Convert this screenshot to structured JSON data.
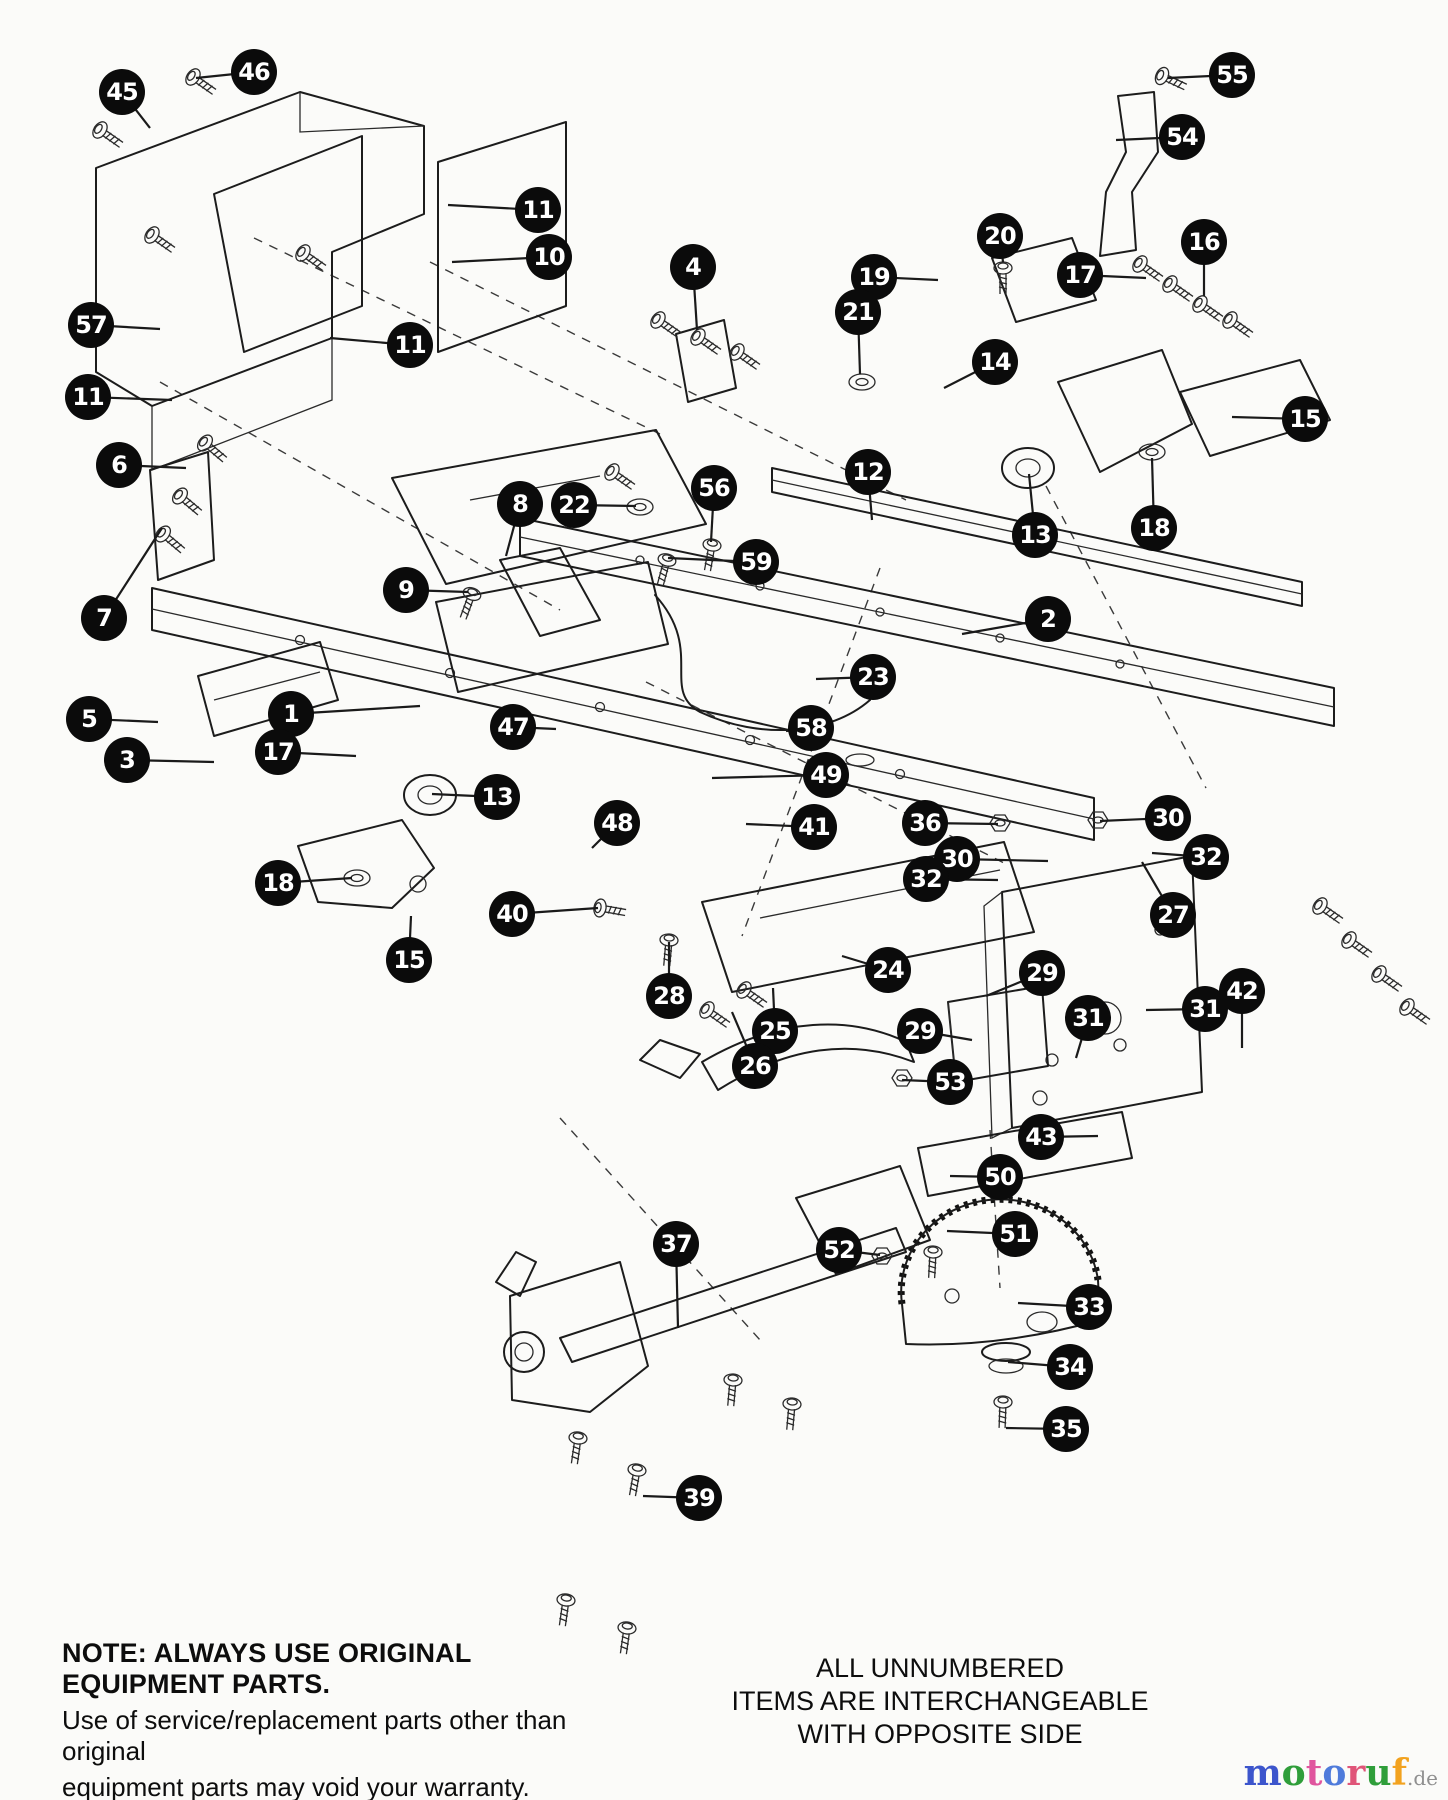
{
  "page": {
    "width": 1448,
    "height": 1800,
    "background": "#fbfbf9"
  },
  "diagram": {
    "description": "Exploded parts diagram of tractor frame assembly",
    "callout_style": {
      "fill": "#0b0b0b",
      "text_color": "#ffffff",
      "diameter": 46,
      "leader_color": "#1a1a1a"
    },
    "callouts": [
      {
        "n": "45",
        "x": 122,
        "y": 92,
        "tx": 150,
        "ty": 128
      },
      {
        "n": "46",
        "x": 254,
        "y": 72,
        "tx": 196,
        "ty": 78
      },
      {
        "n": "55",
        "x": 1232,
        "y": 75,
        "tx": 1168,
        "ty": 78
      },
      {
        "n": "54",
        "x": 1182,
        "y": 137,
        "tx": 1116,
        "ty": 140
      },
      {
        "n": "11",
        "x": 538,
        "y": 210,
        "tx": 448,
        "ty": 205
      },
      {
        "n": "10",
        "x": 549,
        "y": 257,
        "tx": 452,
        "ty": 262
      },
      {
        "n": "20",
        "x": 1000,
        "y": 236,
        "tx": 1003,
        "ty": 262
      },
      {
        "n": "16",
        "x": 1204,
        "y": 242,
        "tx": 1204,
        "ty": 296
      },
      {
        "n": "19",
        "x": 874,
        "y": 277,
        "tx": 938,
        "ty": 280
      },
      {
        "n": "17",
        "x": 1080,
        "y": 275,
        "tx": 1146,
        "ty": 278
      },
      {
        "n": "21",
        "x": 858,
        "y": 312,
        "tx": 860,
        "ty": 374
      },
      {
        "n": "4",
        "x": 693,
        "y": 267,
        "tx": 697,
        "ty": 330
      },
      {
        "n": "57",
        "x": 91,
        "y": 325,
        "tx": 160,
        "ty": 329
      },
      {
        "n": "11",
        "x": 410,
        "y": 345,
        "tx": 330,
        "ty": 338
      },
      {
        "n": "14",
        "x": 995,
        "y": 362,
        "tx": 944,
        "ty": 388
      },
      {
        "n": "11",
        "x": 88,
        "y": 397,
        "tx": 172,
        "ty": 400
      },
      {
        "n": "15",
        "x": 1305,
        "y": 419,
        "tx": 1232,
        "ty": 417
      },
      {
        "n": "6",
        "x": 119,
        "y": 465,
        "tx": 186,
        "ty": 468
      },
      {
        "n": "12",
        "x": 868,
        "y": 472,
        "tx": 872,
        "ty": 520
      },
      {
        "n": "8",
        "x": 520,
        "y": 504,
        "tx": 506,
        "ty": 556
      },
      {
        "n": "22",
        "x": 574,
        "y": 505,
        "tx": 636,
        "ty": 506
      },
      {
        "n": "56",
        "x": 714,
        "y": 488,
        "tx": 711,
        "ty": 542
      },
      {
        "n": "13",
        "x": 1035,
        "y": 535,
        "tx": 1029,
        "ty": 474
      },
      {
        "n": "18",
        "x": 1154,
        "y": 528,
        "tx": 1152,
        "ty": 458
      },
      {
        "n": "59",
        "x": 756,
        "y": 562,
        "tx": 668,
        "ty": 558
      },
      {
        "n": "9",
        "x": 406,
        "y": 590,
        "tx": 468,
        "ty": 592
      },
      {
        "n": "2",
        "x": 1048,
        "y": 619,
        "tx": 962,
        "ty": 634
      },
      {
        "n": "7",
        "x": 104,
        "y": 618,
        "tx": 162,
        "ty": 528
      },
      {
        "n": "23",
        "x": 873,
        "y": 677,
        "tx": 816,
        "ty": 679
      },
      {
        "n": "5",
        "x": 89,
        "y": 719,
        "tx": 158,
        "ty": 722
      },
      {
        "n": "1",
        "x": 291,
        "y": 714,
        "tx": 420,
        "ty": 706
      },
      {
        "n": "47",
        "x": 513,
        "y": 727,
        "tx": 556,
        "ty": 729
      },
      {
        "n": "58",
        "x": 811,
        "y": 728,
        "tx": 786,
        "ty": 731
      },
      {
        "n": "3",
        "x": 127,
        "y": 760,
        "tx": 214,
        "ty": 762
      },
      {
        "n": "17",
        "x": 278,
        "y": 752,
        "tx": 356,
        "ty": 756
      },
      {
        "n": "49",
        "x": 826,
        "y": 775,
        "tx": 712,
        "ty": 778
      },
      {
        "n": "13",
        "x": 497,
        "y": 797,
        "tx": 432,
        "ty": 794
      },
      {
        "n": "48",
        "x": 617,
        "y": 823,
        "tx": 592,
        "ty": 848
      },
      {
        "n": "30",
        "x": 1168,
        "y": 818,
        "tx": 1100,
        "ty": 821
      },
      {
        "n": "41",
        "x": 814,
        "y": 827,
        "tx": 746,
        "ty": 824
      },
      {
        "n": "36",
        "x": 925,
        "y": 823,
        "tx": 998,
        "ty": 824
      },
      {
        "n": "32",
        "x": 1206,
        "y": 857,
        "tx": 1152,
        "ty": 853
      },
      {
        "n": "30",
        "x": 957,
        "y": 859,
        "tx": 1048,
        "ty": 861
      },
      {
        "n": "32",
        "x": 926,
        "y": 879,
        "tx": 998,
        "ty": 880
      },
      {
        "n": "18",
        "x": 278,
        "y": 883,
        "tx": 352,
        "ty": 878
      },
      {
        "n": "27",
        "x": 1173,
        "y": 915,
        "tx": 1142,
        "ty": 862
      },
      {
        "n": "40",
        "x": 512,
        "y": 914,
        "tx": 598,
        "ty": 908
      },
      {
        "n": "15",
        "x": 409,
        "y": 960,
        "tx": 411,
        "ty": 916
      },
      {
        "n": "24",
        "x": 888,
        "y": 970,
        "tx": 842,
        "ty": 956
      },
      {
        "n": "29",
        "x": 1042,
        "y": 973,
        "tx": 986,
        "ty": 996
      },
      {
        "n": "28",
        "x": 669,
        "y": 996,
        "tx": 669,
        "ty": 942
      },
      {
        "n": "31",
        "x": 1205,
        "y": 1009,
        "tx": 1146,
        "ty": 1010
      },
      {
        "n": "31",
        "x": 1088,
        "y": 1018,
        "tx": 1076,
        "ty": 1058
      },
      {
        "n": "42",
        "x": 1242,
        "y": 991,
        "tx": 1242,
        "ty": 1048
      },
      {
        "n": "25",
        "x": 775,
        "y": 1031,
        "tx": 773,
        "ty": 988
      },
      {
        "n": "29",
        "x": 920,
        "y": 1031,
        "tx": 972,
        "ty": 1040
      },
      {
        "n": "26",
        "x": 755,
        "y": 1066,
        "tx": 732,
        "ty": 1012
      },
      {
        "n": "53",
        "x": 950,
        "y": 1082,
        "tx": 902,
        "ty": 1080
      },
      {
        "n": "43",
        "x": 1041,
        "y": 1137,
        "tx": 1098,
        "ty": 1136
      },
      {
        "n": "50",
        "x": 1000,
        "y": 1177,
        "tx": 950,
        "ty": 1176
      },
      {
        "n": "51",
        "x": 1015,
        "y": 1234,
        "tx": 947,
        "ty": 1231
      },
      {
        "n": "37",
        "x": 676,
        "y": 1244,
        "tx": 678,
        "ty": 1328
      },
      {
        "n": "52",
        "x": 839,
        "y": 1250,
        "tx": 880,
        "ty": 1255
      },
      {
        "n": "33",
        "x": 1089,
        "y": 1307,
        "tx": 1018,
        "ty": 1303
      },
      {
        "n": "34",
        "x": 1070,
        "y": 1367,
        "tx": 1008,
        "ty": 1362
      },
      {
        "n": "35",
        "x": 1066,
        "y": 1429,
        "tx": 1006,
        "ty": 1428
      },
      {
        "n": "39",
        "x": 699,
        "y": 1498,
        "tx": 643,
        "ty": 1496
      }
    ]
  },
  "notes": {
    "warning": {
      "line1": "NOTE: ALWAYS USE ORIGINAL EQUIPMENT PARTS.",
      "line2": "Use of service/replacement parts other than original",
      "line3": "equipment parts may void your warranty."
    },
    "interchange": {
      "line1": "ALL UNNUMBERED",
      "line2": "ITEMS ARE INTERCHANGEABLE",
      "line3": "WITH OPPOSITE SIDE"
    }
  },
  "watermark": {
    "letters": [
      {
        "ch": "m",
        "color": "#3c55cc"
      },
      {
        "ch": "o",
        "color": "#2f9e3a"
      },
      {
        "ch": "t",
        "color": "#e0559e"
      },
      {
        "ch": "o",
        "color": "#4f7bdb"
      },
      {
        "ch": "r",
        "color": "#e05579"
      },
      {
        "ch": "u",
        "color": "#2f9e3a"
      },
      {
        "ch": "f",
        "color": "#f2a21f"
      }
    ],
    "suffix": ".de",
    "suffix_color": "#8f8f8f"
  }
}
